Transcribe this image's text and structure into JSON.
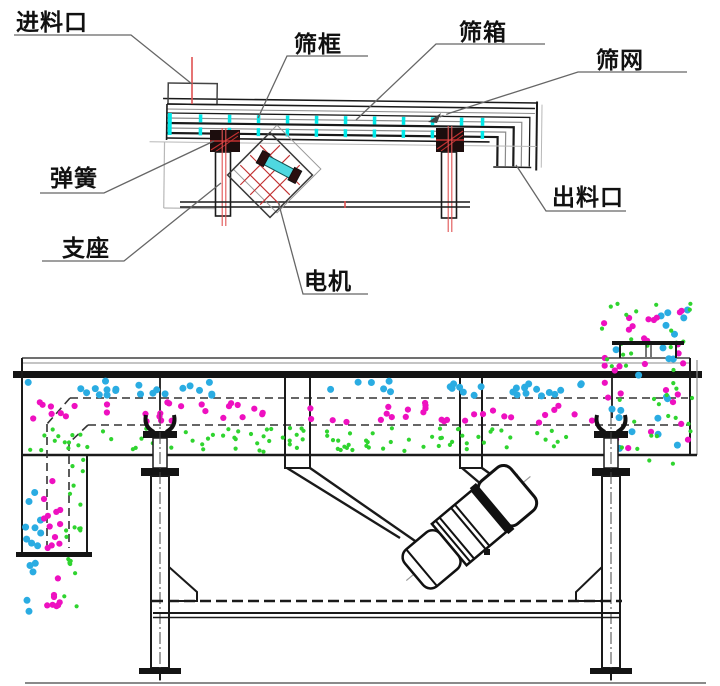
{
  "labels": {
    "feed_inlet": "进料口",
    "screen_frame": "筛框",
    "screen_box": "筛箱",
    "screen_mesh": "筛网",
    "spring": "弹簧",
    "support": "支座",
    "motor": "电机",
    "discharge_outlet": "出料口"
  },
  "colors": {
    "line_dark": "#1a1a1a",
    "line_gray": "#8a8a8a",
    "line_light": "#b8b8b8",
    "leader": "#666666",
    "centerline_red": "#e05252",
    "hatch_red": "#c03030",
    "highlight_cyan": "#00e8e8",
    "spring_block": "#1c0d0d",
    "motor_cyan": "#4fd8e0",
    "particle_blue": "#2aace2",
    "particle_magenta": "#ee10c0",
    "particle_green": "#2fd42f"
  },
  "particles": {
    "seed": 987654321,
    "bands": [
      {
        "layer": "top-deck-oversize",
        "color": "particle_blue",
        "x": [
          28,
          598
        ],
        "y": [
          381,
          396
        ],
        "n": 48,
        "r": 3.5
      },
      {
        "layer": "feed-column-blue",
        "color": "particle_blue",
        "x": [
          604,
          688
        ],
        "y": [
          305,
          450
        ],
        "n": 22,
        "r": 3.5
      },
      {
        "layer": "left-channel-blue",
        "color": "particle_blue",
        "x": [
          25,
          41
        ],
        "y": [
          458,
          547
        ],
        "n": 9,
        "r": 3.5
      },
      {
        "layer": "left-stream-blue",
        "color": "particle_blue",
        "x": [
          25,
          37
        ],
        "y": [
          558,
          612
        ],
        "n": 5,
        "r": 3.5
      },
      {
        "layer": "mid-deck-medium",
        "color": "particle_magenta",
        "x": [
          26,
          598
        ],
        "y": [
          402,
          423
        ],
        "n": 58,
        "r": 3.1
      },
      {
        "layer": "feed-column-magenta",
        "color": "particle_magenta",
        "x": [
          604,
          690
        ],
        "y": [
          304,
          460
        ],
        "n": 30,
        "r": 3.1
      },
      {
        "layer": "left-channel-magenta",
        "color": "particle_magenta",
        "x": [
          44,
          64
        ],
        "y": [
          458,
          550
        ],
        "n": 12,
        "r": 3.1
      },
      {
        "layer": "left-stream-magenta",
        "color": "particle_magenta",
        "x": [
          42,
          60
        ],
        "y": [
          556,
          616
        ],
        "n": 8,
        "r": 3.1
      },
      {
        "layer": "bottom-deck-fines",
        "color": "particle_green",
        "x": [
          26,
          598
        ],
        "y": [
          428,
          452
        ],
        "n": 95,
        "r": 2.1
      },
      {
        "layer": "feed-column-green",
        "color": "particle_green",
        "x": [
          602,
          692
        ],
        "y": [
          303,
          465
        ],
        "n": 40,
        "r": 2.1
      },
      {
        "layer": "left-channel-green",
        "color": "particle_green",
        "x": [
          66,
          85
        ],
        "y": [
          442,
          550
        ],
        "n": 15,
        "r": 2.1
      },
      {
        "layer": "left-stream-green",
        "color": "particle_green",
        "x": [
          64,
          80
        ],
        "y": [
          554,
          610
        ],
        "n": 8,
        "r": 2.1
      }
    ]
  }
}
